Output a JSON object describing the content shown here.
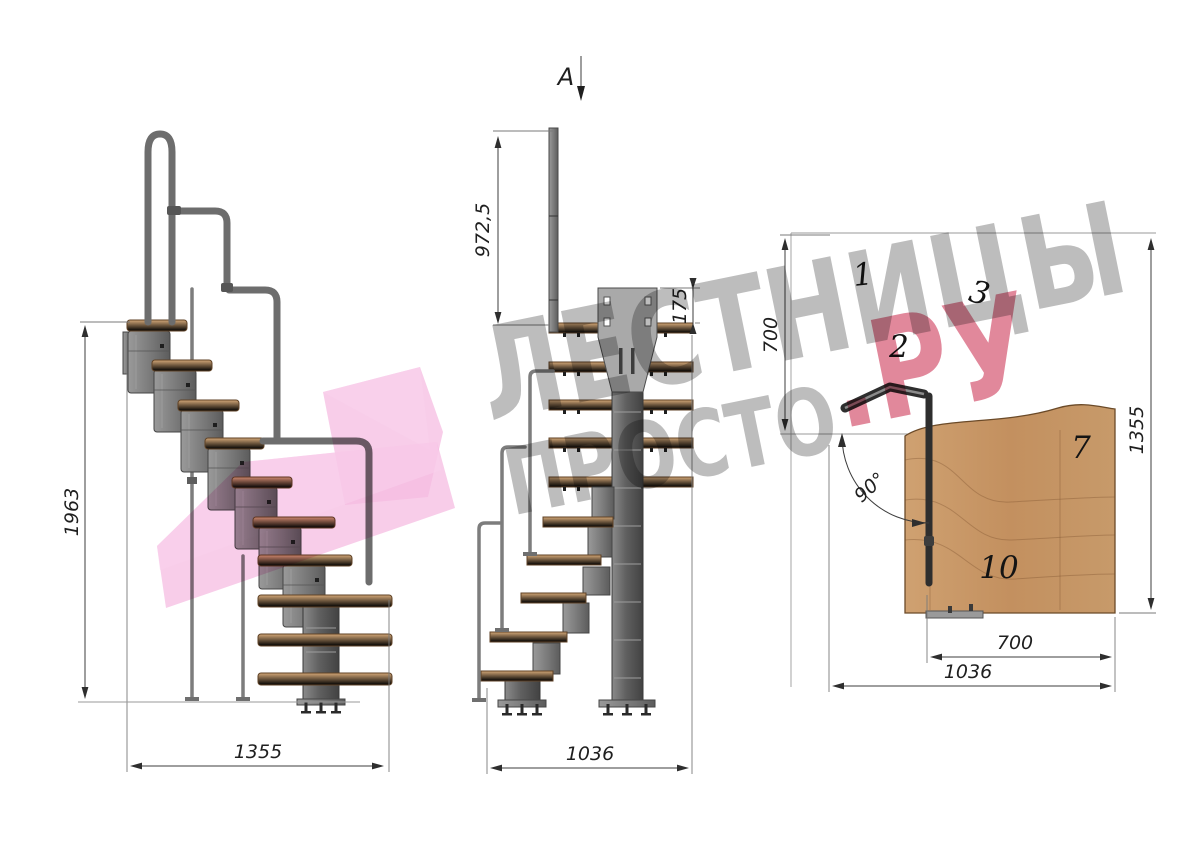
{
  "watermark": {
    "line1": "ЛЕСТНИЦЫ",
    "line2_gray": "ПРОСТО",
    "line2_red": ".РУ"
  },
  "side_view": {
    "height_dim": "1963",
    "width_dim": "1355"
  },
  "front_view": {
    "section_label": "A",
    "rail_height_dim": "972,5",
    "plate_height_dim": "175",
    "width_dim": "1036"
  },
  "plan_view": {
    "flight_length_dim": "700",
    "depth_dim": "1355",
    "tread_width_dim": "700",
    "width_dim": "1036",
    "angle_dim": "90°",
    "tread_numbers": [
      "1",
      "2",
      "3",
      "7",
      "10"
    ]
  },
  "colors": {
    "wood": "#c89a6b",
    "metal": "#808080",
    "logo_pink": "#f3b8e0",
    "watermark_red": "#c92648",
    "watermark_gray": "#ababab"
  }
}
